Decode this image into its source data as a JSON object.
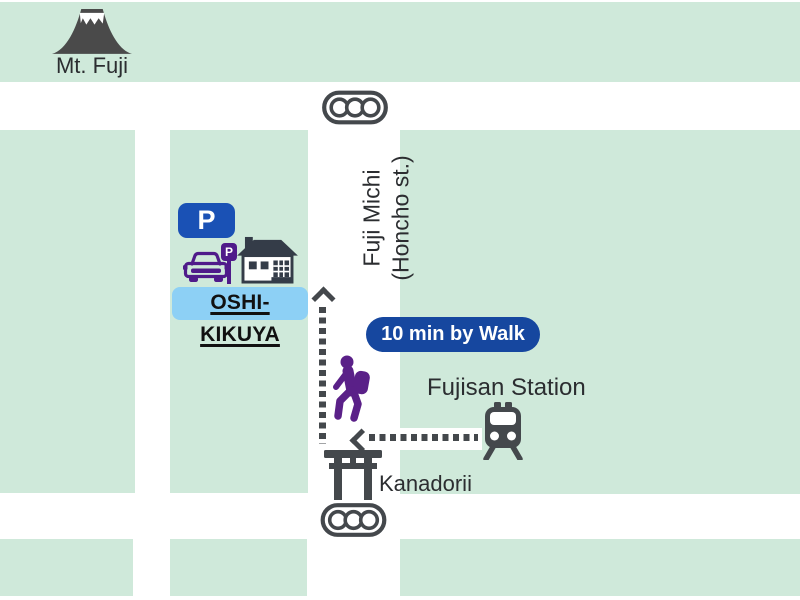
{
  "labels": {
    "mt_fuji": "Mt. Fuji",
    "street_line1": "Fuji Michi",
    "street_line2": "(Honcho st.)",
    "parking_sign": "P",
    "mini_parking_sign": "P",
    "destination": "OSHI-KIKUYA",
    "walk_badge": "10 min by Walk",
    "station": "Fujisan Station",
    "torii": "Kanadorii"
  },
  "colors": {
    "block_green": "#cfe9da",
    "road_white": "#ffffff",
    "parking_blue": "#1a51b5",
    "badge_blue": "#16479f",
    "destination_highlight": "#8dd0f5",
    "icon_dark_gray": "#44484c",
    "mtfuji_gray": "#4a4a4a",
    "house_dark": "#343c48",
    "hiker_purple": "#5a2088",
    "car_purple": "#4f1b8a",
    "text_dark": "#2b2d30"
  }
}
